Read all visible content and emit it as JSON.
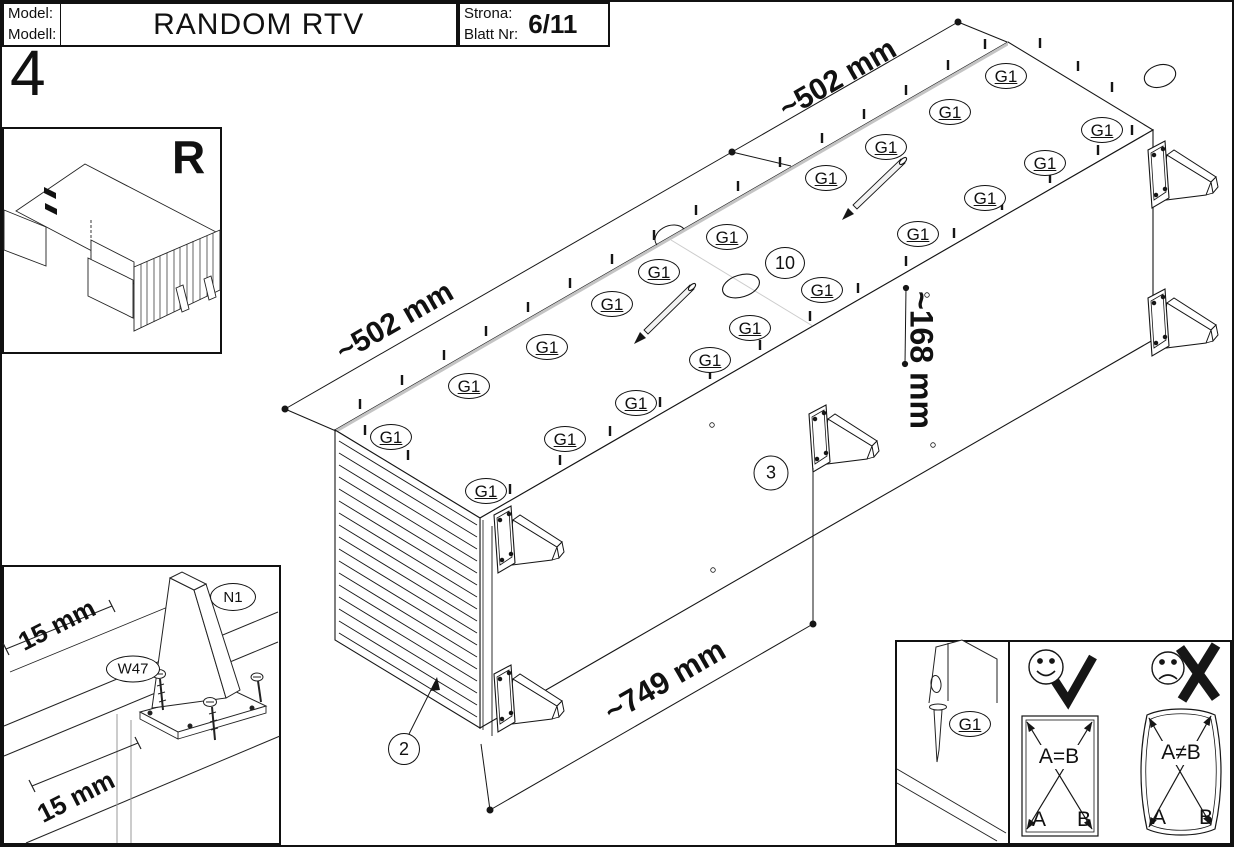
{
  "header": {
    "model_label": "Model:",
    "modell_label": "Modell:",
    "title": "RANDOM RTV",
    "strona_label": "Strona:",
    "blatt_label": "Blatt Nr:",
    "page": "6/11"
  },
  "step_number": "4",
  "mirror_mark": "R",
  "g1_label": "G1",
  "g1_markers": [
    {
      "x": 1006,
      "y": 76
    },
    {
      "x": 950,
      "y": 112
    },
    {
      "x": 1102,
      "y": 130
    },
    {
      "x": 886,
      "y": 147
    },
    {
      "x": 1045,
      "y": 163
    },
    {
      "x": 826,
      "y": 178
    },
    {
      "x": 985,
      "y": 198
    },
    {
      "x": 918,
      "y": 234
    },
    {
      "x": 727,
      "y": 237
    },
    {
      "x": 659,
      "y": 272
    },
    {
      "x": 612,
      "y": 304
    },
    {
      "x": 822,
      "y": 290
    },
    {
      "x": 750,
      "y": 328
    },
    {
      "x": 547,
      "y": 347
    },
    {
      "x": 710,
      "y": 360
    },
    {
      "x": 469,
      "y": 386
    },
    {
      "x": 636,
      "y": 403
    },
    {
      "x": 391,
      "y": 437
    },
    {
      "x": 565,
      "y": 439
    },
    {
      "x": 486,
      "y": 491
    },
    {
      "x": 970,
      "y": 724
    }
  ],
  "dimensions": [
    {
      "text": "~502 mm",
      "x": 395,
      "y": 322,
      "rot": -30,
      "size": 30
    },
    {
      "text": "~502 mm",
      "x": 838,
      "y": 79,
      "rot": -30,
      "size": 30
    },
    {
      "text": "~168 mm",
      "x": 921,
      "y": 360,
      "rot": 90,
      "size": 32
    },
    {
      "text": "~749 mm",
      "x": 665,
      "y": 681,
      "rot": -30,
      "size": 31
    },
    {
      "text": "15 mm",
      "x": 57,
      "y": 625,
      "rot": -27,
      "size": 26
    },
    {
      "text": "15 mm",
      "x": 76,
      "y": 797,
      "rot": -27,
      "size": 26
    }
  ],
  "part_labels": [
    {
      "text": "N1",
      "x": 233,
      "y": 597,
      "w": 44,
      "h": 26
    },
    {
      "text": "W47",
      "x": 133,
      "y": 669,
      "w": 52,
      "h": 25
    }
  ],
  "callouts": [
    {
      "text": "10",
      "x": 785,
      "y": 263,
      "w": 38,
      "h": 30
    },
    {
      "text": "3",
      "x": 771,
      "y": 473,
      "w": 33,
      "h": 33
    },
    {
      "text": "2",
      "x": 404,
      "y": 749,
      "w": 30,
      "h": 30
    }
  ],
  "compare": {
    "ok_label": "A=B",
    "bad_label": "A≠B",
    "corner_a": "A",
    "corner_b": "B"
  },
  "colors": {
    "line": "#161616",
    "edge_shade": "#bdbdbd"
  }
}
